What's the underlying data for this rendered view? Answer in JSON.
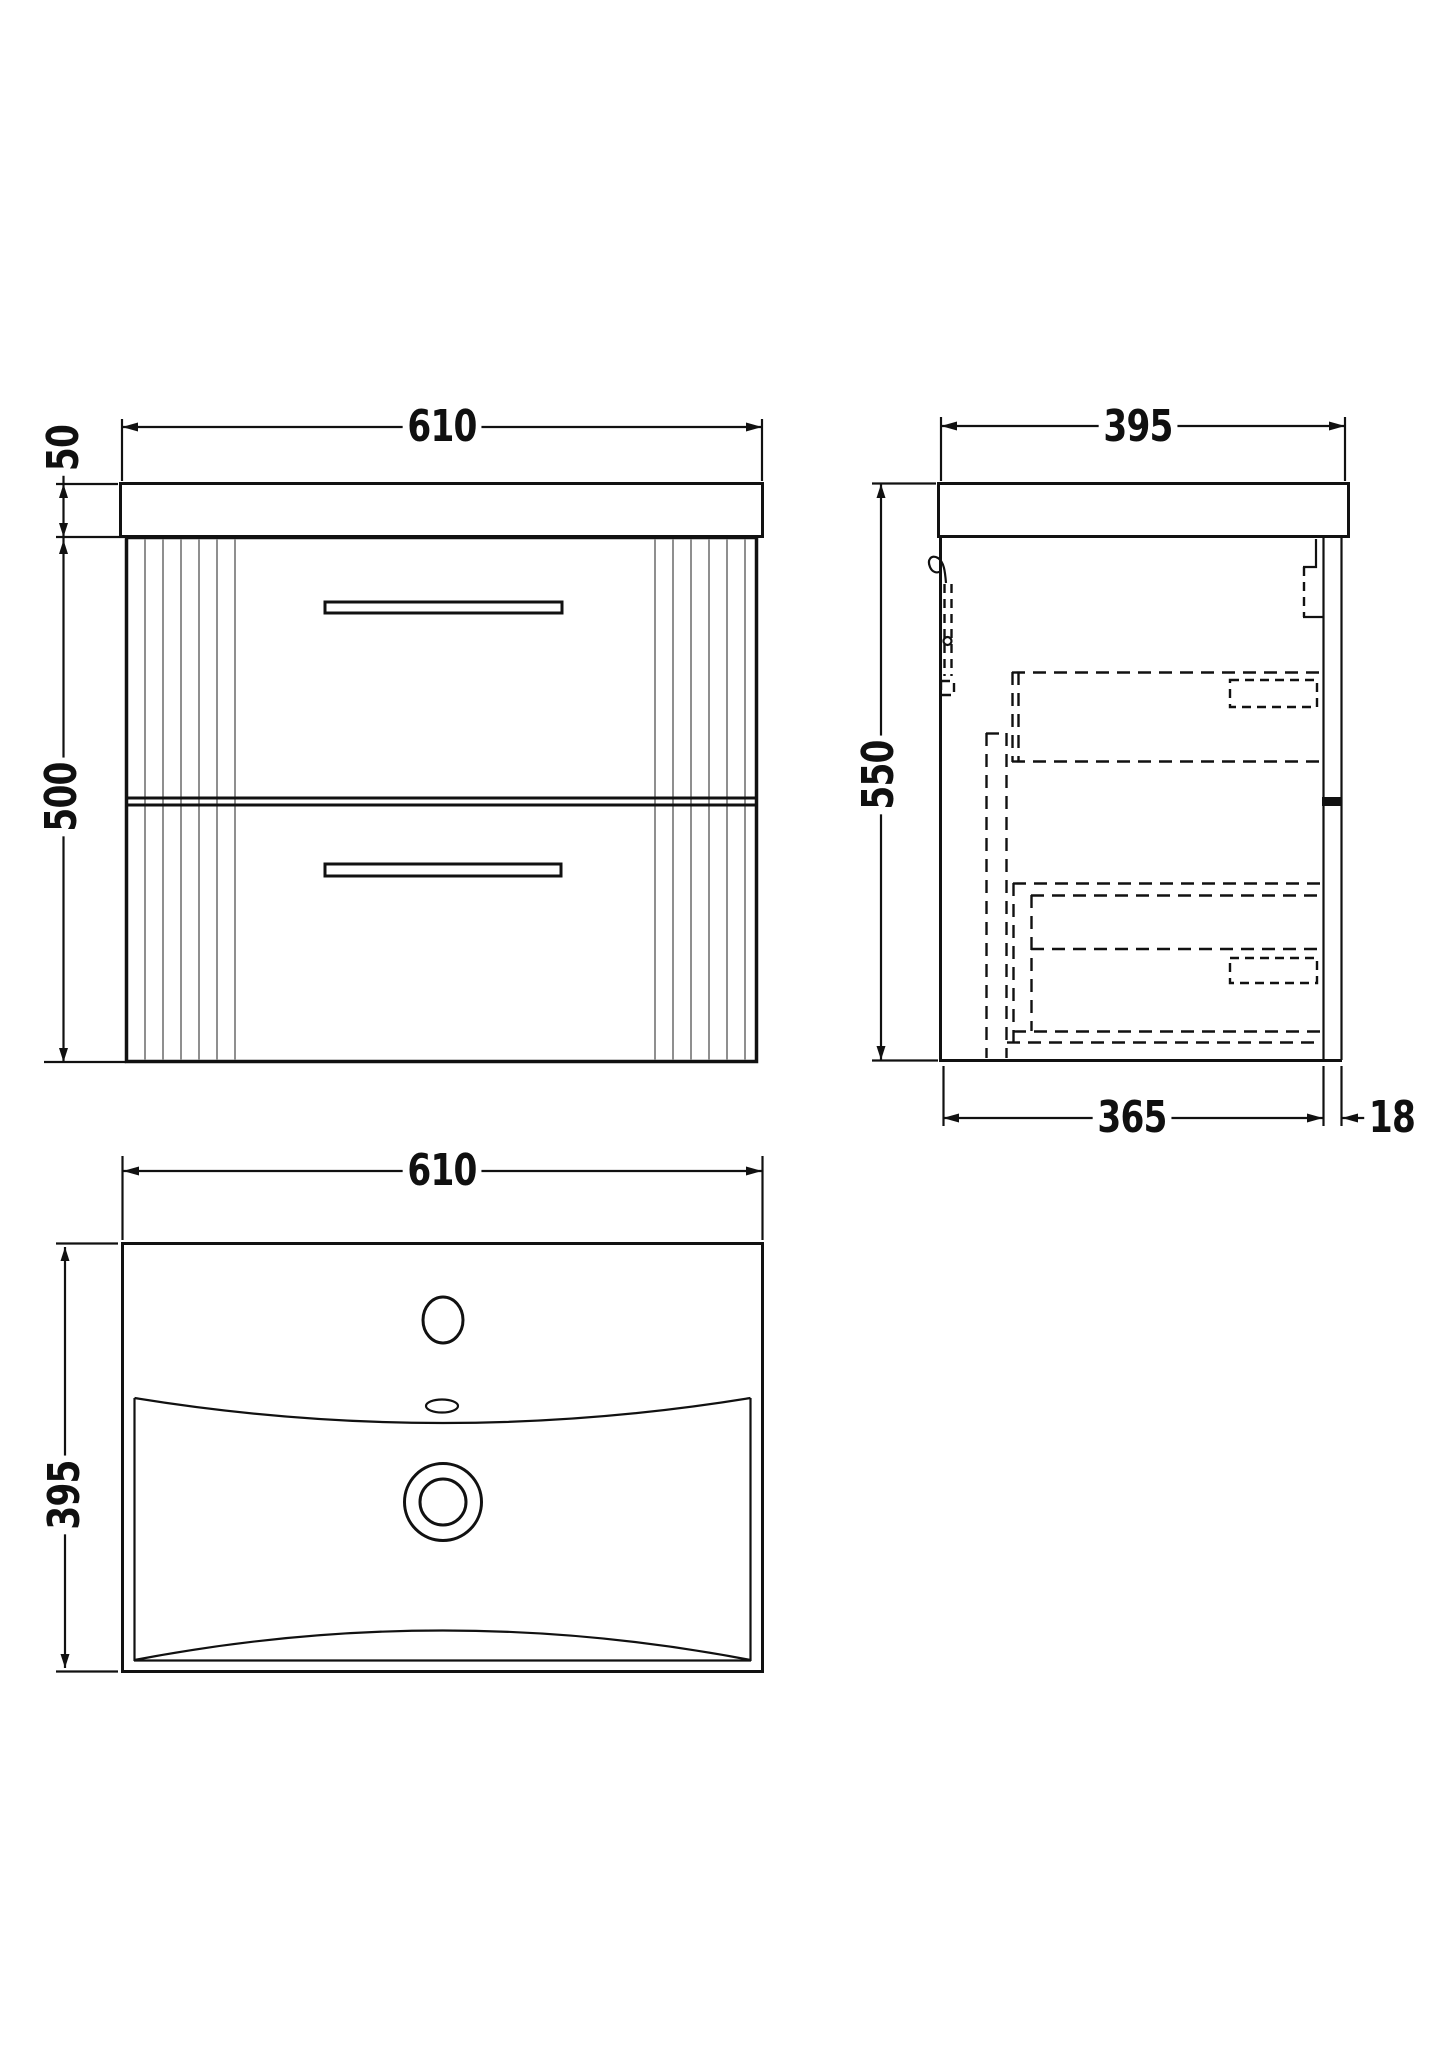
{
  "drawing": {
    "background_color": "#ffffff",
    "line_color": "#111111",
    "flute_color": "#8f8f8f",
    "views": {
      "front": {
        "dims": {
          "width": "610",
          "worktop_height": "50",
          "cabinet_height": "500"
        }
      },
      "side": {
        "dims": {
          "depth": "395",
          "overall_height": "550",
          "cabinet_depth": "365",
          "back_panel_thickness": "18"
        }
      },
      "plan": {
        "dims": {
          "width": "610",
          "depth": "395"
        }
      }
    }
  }
}
